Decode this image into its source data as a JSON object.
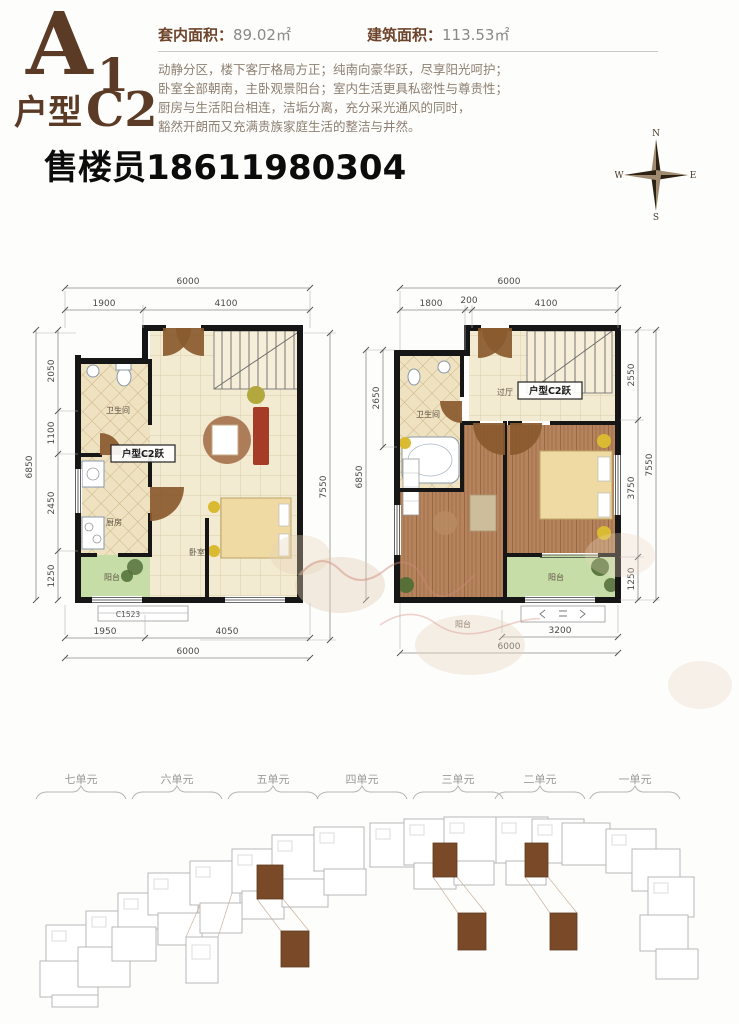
{
  "header": {
    "code_main": "A",
    "code_main_sub": "1",
    "code_type": "户型",
    "code_type_sub": "C2",
    "interior_area_label": "套内面积：",
    "interior_area_value": "89.02㎡",
    "gross_area_label": "建筑面积：",
    "gross_area_value": "113.53㎡",
    "description_lines": [
      "动静分区，楼下客厅格局方正；纯南向豪华跃，尽享阳光呵护；",
      "卧室全部朝南，主卧观景阳台；室内生活更具私密性与尊贵性；",
      "厨房与生活阳台相连，洁垢分离，充分采光通风的同时，",
      "豁然开朗而又充满贵族家庭生活的整洁与井然。"
    ],
    "agent_phone": "售楼员18611980304"
  },
  "compass": {
    "n": "N",
    "e": "E",
    "s": "S",
    "w": "W"
  },
  "plan_left": {
    "tag": "户型C2跃",
    "rooms": {
      "bathroom": "卫生间",
      "kitchen": "厨房",
      "balcony": "阳台",
      "bedroom": "卧室"
    },
    "dims": {
      "top_overall": "6000",
      "top_a": "1900",
      "top_b": "4100",
      "left_overall": "6850",
      "left_a": "2050",
      "left_b": "1100",
      "left_c": "2450",
      "left_d": "1250",
      "right_overall": "7550",
      "bottom_a": "1950",
      "bottom_b": "4050",
      "bottom_overall": "6000",
      "window_code": "C1523"
    }
  },
  "plan_right": {
    "tag": "户型C2跃",
    "rooms": {
      "bathroom": "卫生间",
      "hallway": "过厅",
      "balcony": "阳台",
      "balcony_lower": "阳台"
    },
    "dims": {
      "top_overall": "6000",
      "top_a": "1800",
      "top_b": "200",
      "top_c": "4100",
      "left_a": "2650",
      "left_overall": "6850",
      "right_a": "2550",
      "right_b": "3750",
      "right_c": "1250",
      "right_overall": "7550",
      "bottom_a": "3200",
      "bottom_overall": "6000"
    }
  },
  "site_plan": {
    "units": [
      "七单元",
      "六单元",
      "五单元",
      "四单元",
      "三单元",
      "二单元",
      "一单元"
    ]
  },
  "colors": {
    "accent_brown": "#5b3a26",
    "door_brown": "#8a5a2e",
    "wall_black": "#161616",
    "floor_cream": "#f3ead2",
    "wood_floor": "#b5845c",
    "balcony_green": "#c6dda8",
    "highlight_unit": "#7a4a28",
    "site_gray": "#b8b8b8"
  }
}
